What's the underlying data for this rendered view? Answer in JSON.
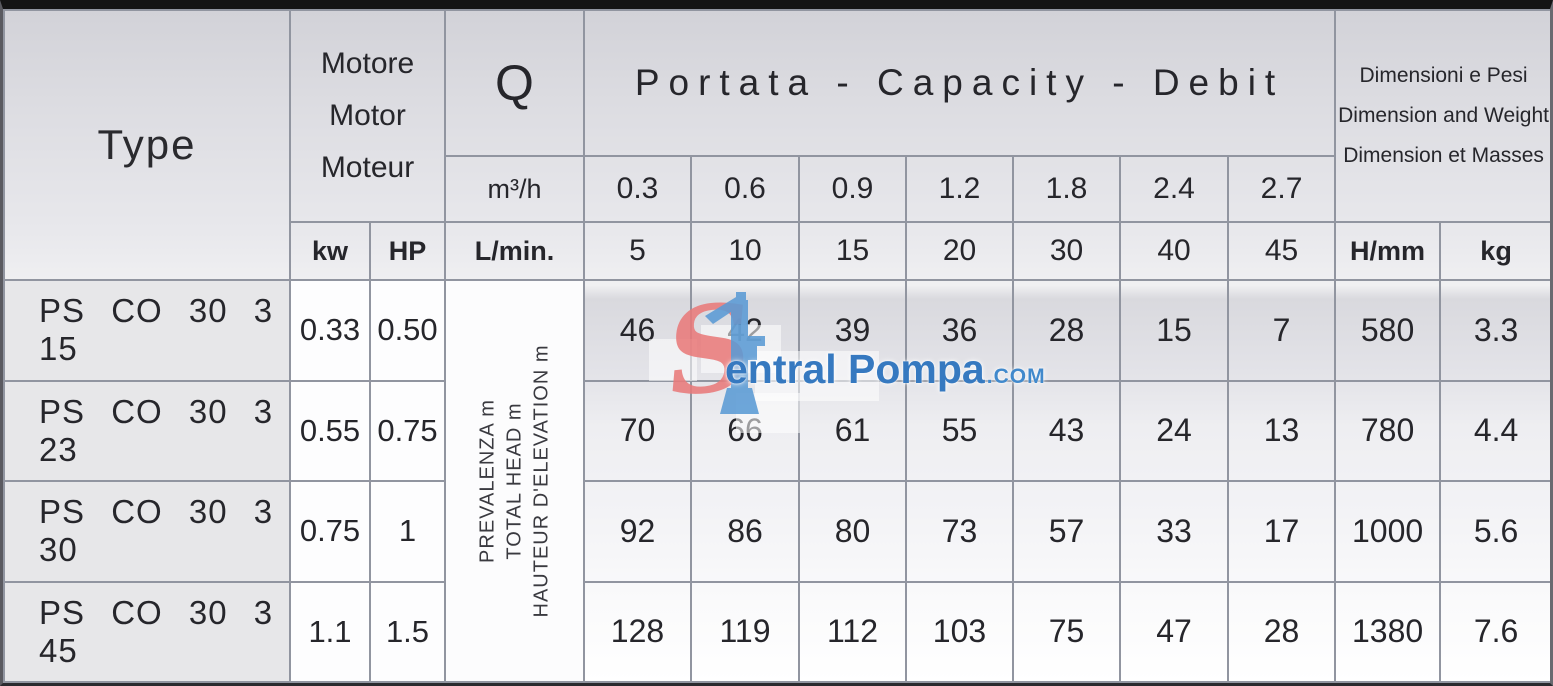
{
  "table": {
    "header": {
      "type_label": "Type",
      "motor_labels": [
        "Motore",
        "Motor",
        "Moteur"
      ],
      "q_label": "Q",
      "portata_label": "Portata - Capacity - Debit",
      "dimensions_labels": [
        "Dimensioni e Pesi",
        "Dimension and Weight",
        "Dimension et Masses"
      ],
      "kw_label": "kw",
      "hp_label": "HP",
      "m3h_label": "m³/h",
      "lmin_label": "L/min.",
      "hmm_label": "H/mm",
      "kg_label": "kg",
      "m3h_values": [
        "0.3",
        "0.6",
        "0.9",
        "1.2",
        "1.8",
        "2.4",
        "2.7"
      ],
      "lmin_values": [
        "5",
        "10",
        "15",
        "20",
        "30",
        "40",
        "45"
      ]
    },
    "head_note": [
      "PREVALENZA m",
      "TOTAL HEAD m",
      "HAUTEUR D'ELEVATION m"
    ],
    "rows": [
      {
        "type": "PS CO 30 3 15",
        "kw": "0.33",
        "hp": "0.50",
        "values": [
          "46",
          "42",
          "39",
          "36",
          "28",
          "15",
          "7"
        ],
        "h_mm": "580",
        "kg": "3.3"
      },
      {
        "type": "PS CO 30 3 23",
        "kw": "0.55",
        "hp": "0.75",
        "values": [
          "70",
          "66",
          "61",
          "55",
          "43",
          "24",
          "13"
        ],
        "h_mm": "780",
        "kg": "4.4"
      },
      {
        "type": "PS CO 30 3 30",
        "kw": "0.75",
        "hp": "1",
        "values": [
          "92",
          "86",
          "80",
          "73",
          "57",
          "33",
          "17"
        ],
        "h_mm": "1000",
        "kg": "5.6"
      },
      {
        "type": "PS CO 30 3 45",
        "kw": "1.1",
        "hp": "1.5",
        "values": [
          "128",
          "119",
          "112",
          "103",
          "75",
          "47",
          "28"
        ],
        "h_mm": "1380",
        "kg": "7.6"
      }
    ],
    "watermark": {
      "initial": "S",
      "text": "entral Pompa",
      "tld": ".COM",
      "red": "#e87a7a",
      "blue_icon": "#5b9bd5",
      "blue_text": "#3679c0"
    }
  }
}
